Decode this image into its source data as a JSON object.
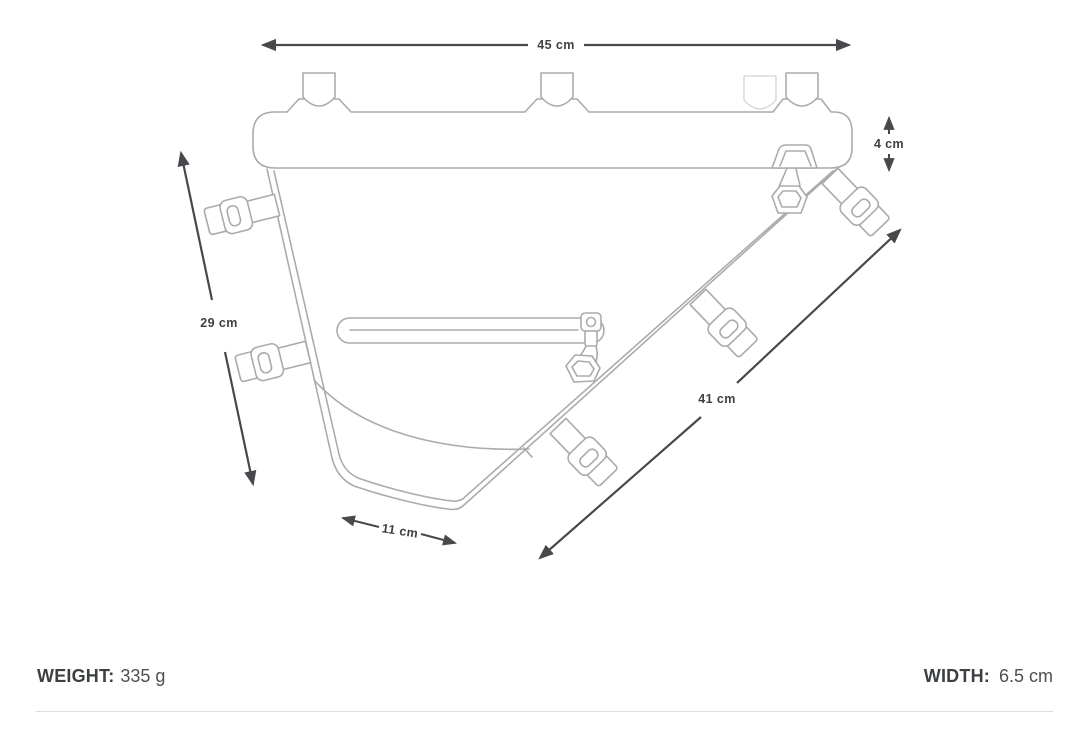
{
  "diagram": {
    "title": "frame-bag-dimension-diagram",
    "dimensions": {
      "top_width": "45 cm",
      "left_height": "29 cm",
      "tube_height": "4 cm",
      "diagonal_length": "41 cm",
      "bottom_width": "11 cm"
    },
    "colors": {
      "outline": "#a9abae",
      "outline_faint": "#d8dadc",
      "dimension": "#47494c",
      "dimension_text": "#3e4144",
      "divider": "#dcdddf"
    }
  },
  "specs": {
    "weight_label": "WEIGHT:",
    "weight_value": "335 g",
    "width_label": "WIDTH:",
    "width_value": "6.5 cm"
  }
}
